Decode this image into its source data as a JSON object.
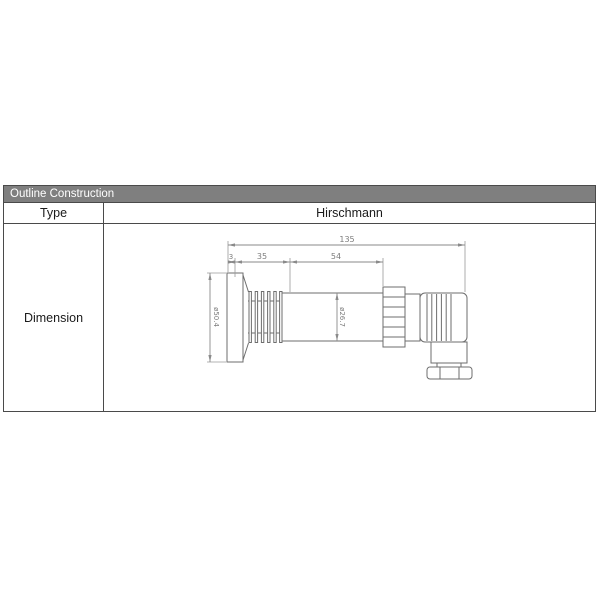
{
  "header": {
    "title": "Outline Construction",
    "bg_color": "#7f7f7f",
    "text_color": "#ffffff"
  },
  "table": {
    "type_label": "Type",
    "type_value": "Hirschmann",
    "dimension_label": "Dimension",
    "border_color": "#4a4a4a"
  },
  "drawing": {
    "line_color": "#6e6e6e",
    "dim_color": "#8a8a8a",
    "dims": {
      "overall_length": "135",
      "port_length": "3",
      "heatsink_length": "35",
      "body_length": "54",
      "flange_diameter": "ø50.4",
      "body_diameter": "ø26.7"
    }
  }
}
